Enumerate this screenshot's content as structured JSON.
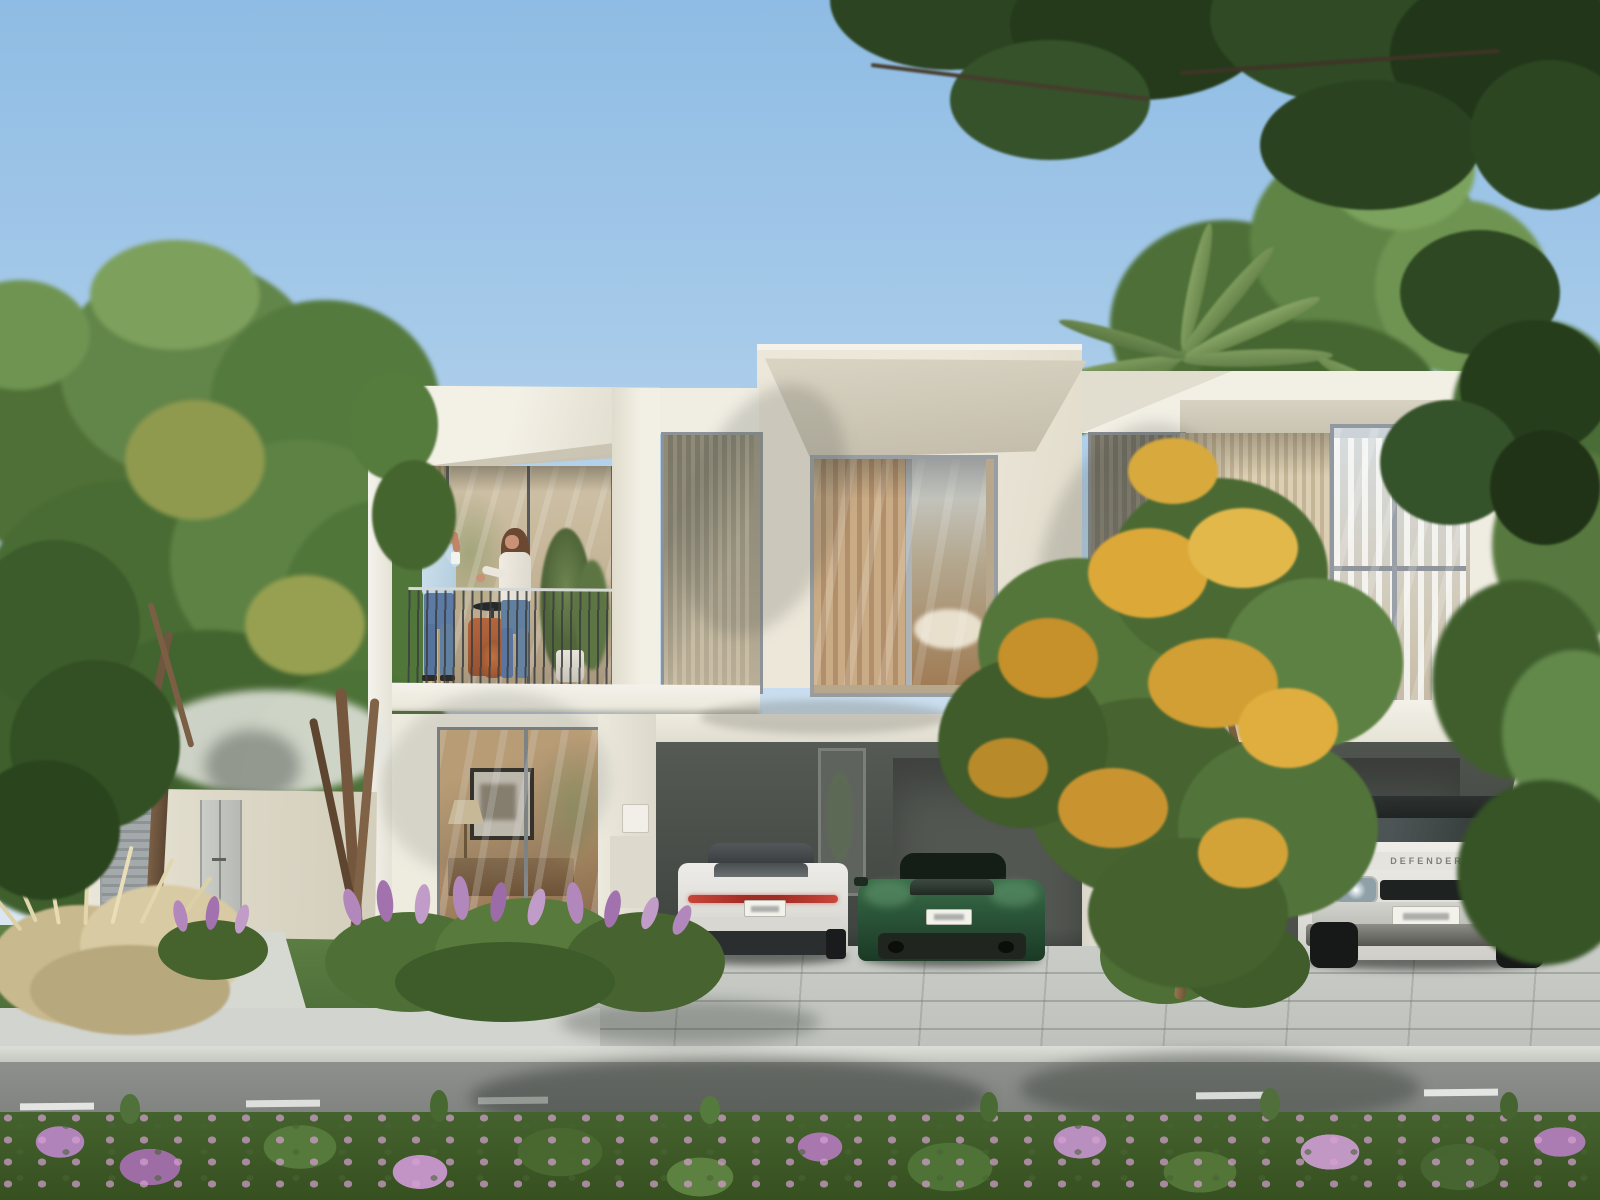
{
  "scene": {
    "label": "modern-villa-exterior-render",
    "time": "day"
  },
  "palette": {
    "sky_top": "#8fbce4",
    "sky_horizon": "#e0ebf4",
    "facade_sunlit": "#f2efe5",
    "facade_cream": "#e9e4d6",
    "soffit_tan": "#cdc5b2",
    "slat_wood": "#d2c3a4",
    "carport_charcoal": "#474b46",
    "curtain_beige": "#c2a27e",
    "curtain_white": "#f4f3f0",
    "glass_reflection": "#cfd6da",
    "road": "#858883",
    "sidewalk": "#d2d4cf",
    "paver": "#c6c9c4",
    "lawn": "#5a7c41",
    "foliage_dark": "#2c4421",
    "foliage_mid": "#507337",
    "foliage_light": "#76985a",
    "flower_yellow": "#dca838",
    "flower_purple": "#b287bc",
    "flower_pink": "#c197c4",
    "plume_grass": "#d9cba4",
    "trunk": "#7a5f45",
    "railing": "#3c4042",
    "taillight_red": "#c13a30"
  },
  "vehicles": {
    "sedan": {
      "type": "sedan",
      "view": "rear",
      "body_color": "#e9e7e3",
      "taillight_color": "#c13a30",
      "plate_color": "#f2f1ea"
    },
    "sports_car": {
      "type": "coupe",
      "view": "rear",
      "body_color": "#2e5a3b",
      "plate_color": "#f2f1ea"
    },
    "suv": {
      "type": "suv",
      "view": "front",
      "body_color": "#ebe9e4",
      "roof_color": "#272b29",
      "hood_text": "DEFENDER",
      "plate_color": "#f2f1ea"
    }
  },
  "people": [
    {
      "location": "balcony",
      "shirt_color": "#c6dbe9",
      "pants": "jeans",
      "hair_color": "#3a2b20"
    },
    {
      "location": "balcony",
      "shirt_color": "#eae6dc",
      "pants": "jeans",
      "hair_color": "#6b4832"
    }
  ]
}
